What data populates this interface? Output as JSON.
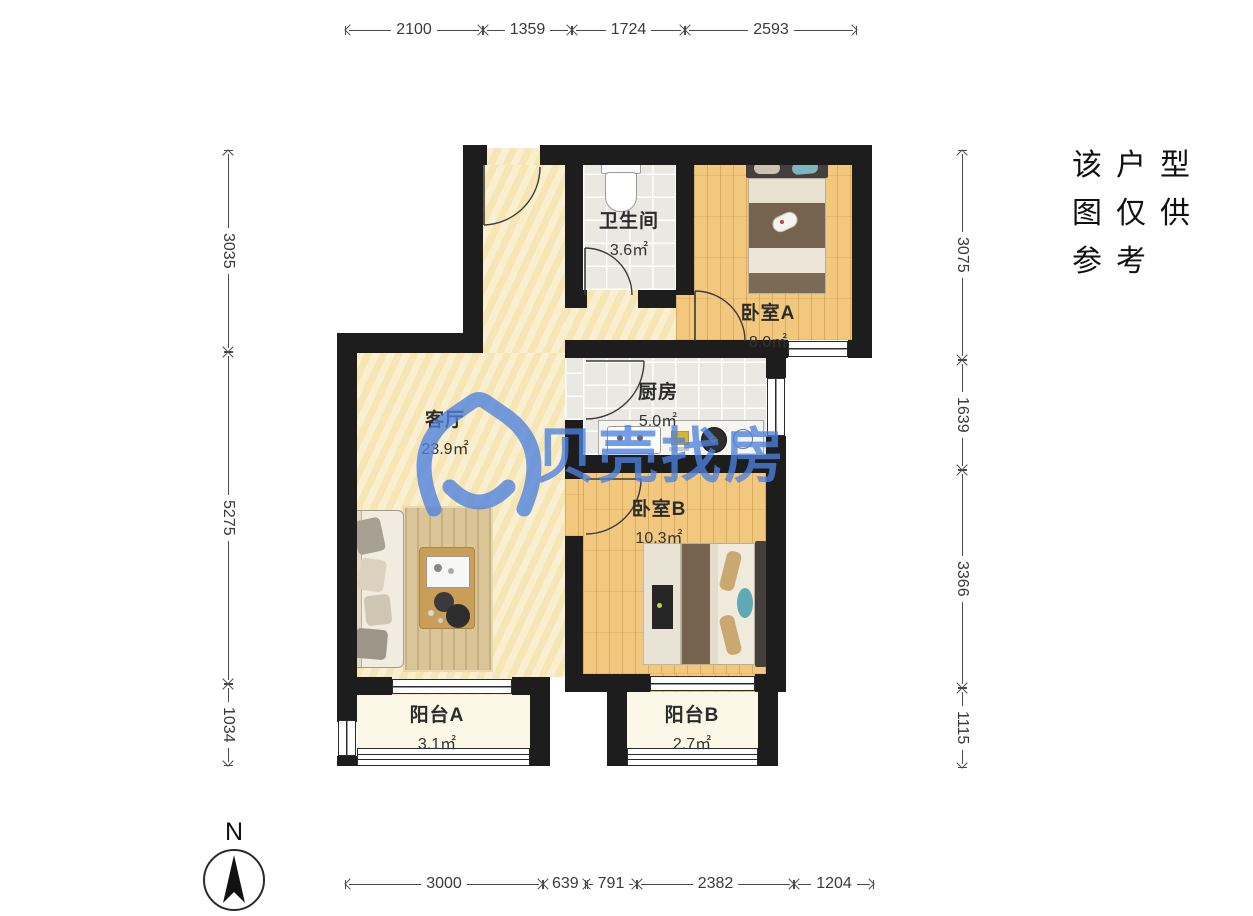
{
  "disclaimer": {
    "lines": [
      "该户型",
      "图仅供",
      "参考"
    ]
  },
  "watermark": {
    "brand": "贝壳找房",
    "color": "#4C82E0"
  },
  "compass": {
    "label": "N"
  },
  "rooms": [
    {
      "name": "客厅",
      "area": "23.9㎡"
    },
    {
      "name": "卫生间",
      "area": "3.6㎡"
    },
    {
      "name": "卧室A",
      "area": "8.0㎡"
    },
    {
      "name": "厨房",
      "area": "5.0㎡"
    },
    {
      "name": "卧室B",
      "area": "10.3㎡"
    },
    {
      "name": "阳台A",
      "area": "3.1㎡"
    },
    {
      "name": "阳台B",
      "area": "2.7㎡"
    }
  ],
  "dimensions_mm": {
    "top": [
      "2100",
      "1359",
      "1724",
      "2593"
    ],
    "bottom": [
      "3000",
      "639",
      "791",
      "2382",
      "1204"
    ],
    "left": [
      "3035",
      "5275",
      "1034"
    ],
    "right": [
      "3075",
      "1639",
      "3366",
      "1115"
    ]
  },
  "colors": {
    "wall": "#1d1d1d",
    "living_floor": "#F7E9BE",
    "wood_floor": "#F1C87E",
    "tile_floor": "#EAE8E2",
    "balcony_floor": "#FBF8E8",
    "watermark_blue": "#4C82E0",
    "dimension_text": "#3a3a3a"
  }
}
